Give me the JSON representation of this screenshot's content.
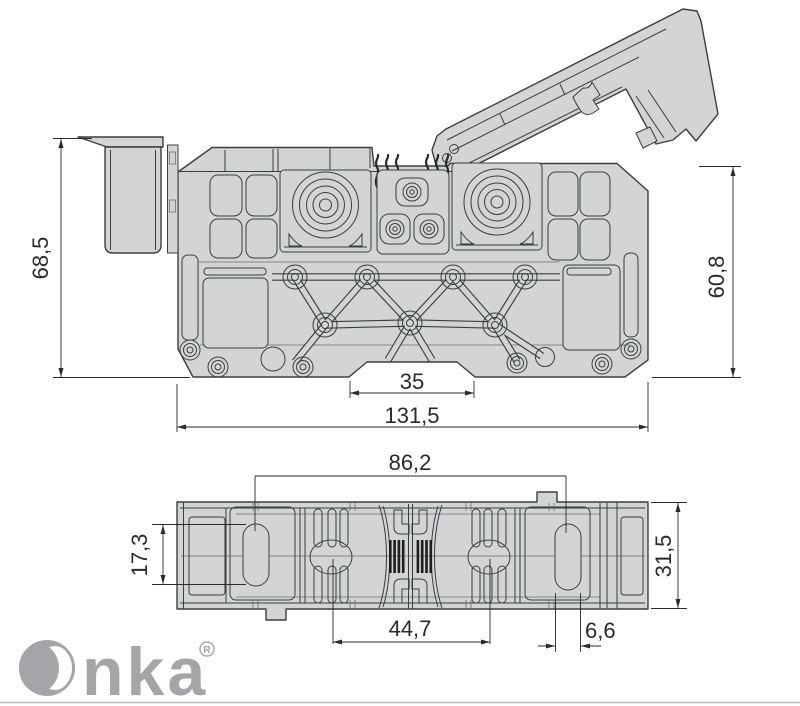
{
  "drawing": {
    "side_view": {
      "dim_total_height": "68,5",
      "dim_right_height": "60,8",
      "dim_rail_notch_width": "35",
      "dim_total_width": "131,5"
    },
    "plan_view": {
      "dim_slot_center_span": "86,2",
      "dim_slot_length": "17,3",
      "dim_body_depth": "31,5",
      "dim_terminal_center_span": "44,7",
      "dim_slot_width": "6,6"
    }
  },
  "brand": {
    "name": "Onka",
    "logo_text_after_o": "nka",
    "registered_mark": "®"
  },
  "colors": {
    "body_fill": "#d2d4d5",
    "line": "#3b3e40",
    "dimension": "#2a2a2a",
    "logo_gray": "#a3a5a8"
  }
}
